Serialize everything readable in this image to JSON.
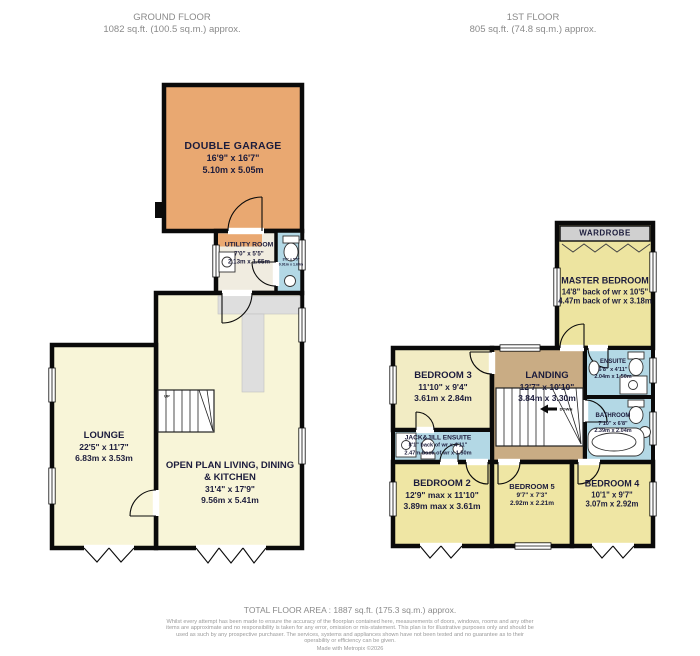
{
  "headers": {
    "ground": {
      "title": "GROUND FLOOR",
      "area": "1082 sq.ft. (100.5 sq.m.) approx."
    },
    "first": {
      "title": "1ST FLOOR",
      "area": "805 sq.ft. (74.8 sq.m.) approx."
    }
  },
  "ground_floor": {
    "garage": {
      "name": "DOUBLE GARAGE",
      "imperial": "16'9\" x 16'7\"",
      "metric": "5.10m x 5.05m"
    },
    "utility": {
      "name": "UTILITY ROOM",
      "imperial": "7'0\" x 5'5\"",
      "metric": "2.13m x 1.65m"
    },
    "wc": {
      "imperial": "3'0\" x 5'5\"",
      "metric": "0.91m x 1.65m"
    },
    "lounge": {
      "name": "LOUNGE",
      "imperial": "22'5\" x 11'7\"",
      "metric": "6.83m x 3.53m"
    },
    "open_plan": {
      "name": "OPEN PLAN LIVING, DINING",
      "name2": "& KITCHEN",
      "imperial": "31'4\" x 17'9\"",
      "metric": "9.56m x 5.41m"
    },
    "stairs_label": "UP"
  },
  "first_floor": {
    "wardrobe": {
      "name": "WARDROBE"
    },
    "master": {
      "name": "MASTER BEDROOM",
      "imperial": "14'8\" back of wr x 10'5\"",
      "metric": "4.47m back of wr x 3.18m"
    },
    "bedroom3": {
      "name": "BEDROOM 3",
      "imperial": "11'10\" x 9'4\"",
      "metric": "3.61m x 2.84m"
    },
    "landing": {
      "name": "LANDING",
      "imperial": "12'7\" x 10'10\"",
      "metric": "3.84m x 3.30m",
      "stairs_label": "DOWN"
    },
    "ensuite": {
      "name": "ENSUITE",
      "imperial": "6'8\" x 4'11\"",
      "metric": "2.04m x 1.50m"
    },
    "bathroom": {
      "name": "BATHROOM",
      "imperial": "7'10\" x 6'8\"",
      "metric": "2.39m x 2.04m"
    },
    "jack_jill": {
      "name": "JACK&JILL ENSUITE",
      "imperial": "8'1\" back of wr x 4'11\"",
      "metric": "2.47m back of wr x 1.50m"
    },
    "bedroom2": {
      "name": "BEDROOM 2",
      "imperial": "12'9\" max x 11'10\"",
      "metric": "3.89m max x 3.61m"
    },
    "bedroom5": {
      "name": "BEDROOM 5",
      "imperial": "9'7\" x 7'3\"",
      "metric": "2.92m x 2.21m"
    },
    "bedroom4": {
      "name": "BEDROOM 4",
      "imperial": "10'1\" x 9'7\"",
      "metric": "3.07m x 2.92m"
    }
  },
  "footer": {
    "total": "TOTAL FLOOR AREA : 1887 sq.ft. (175.3 sq.m.) approx.",
    "disclaimer": "Whilst every attempt has been made to ensure the accuracy of the floorplan contained here, measurements of doors, windows, rooms and any other items are approximate and no responsibility is taken for any error, omission or mis-statement. This plan is for illustrative purposes only and should be used as such by any prospective purchaser. The services, systems and appliances shown have not been tested and no guarantee as to their operability or efficiency can be given.",
    "credit": "Made with Metropix ©2026"
  },
  "colors": {
    "wall": "#0a0a0a",
    "garage": "#e9a871",
    "cream": "#f8f5d8",
    "utility": "#f0ece0",
    "bedroom": "#efe6a4",
    "bedroom3": "#f2ecc4",
    "bath_blue": "#b3d8e5",
    "landing_tan": "#c9ac84",
    "wardrobe_gray": "#d0d0d0",
    "counter_gray": "#dedede",
    "label_text": "#1c1c3c",
    "muted_text": "#8a8a8a"
  }
}
